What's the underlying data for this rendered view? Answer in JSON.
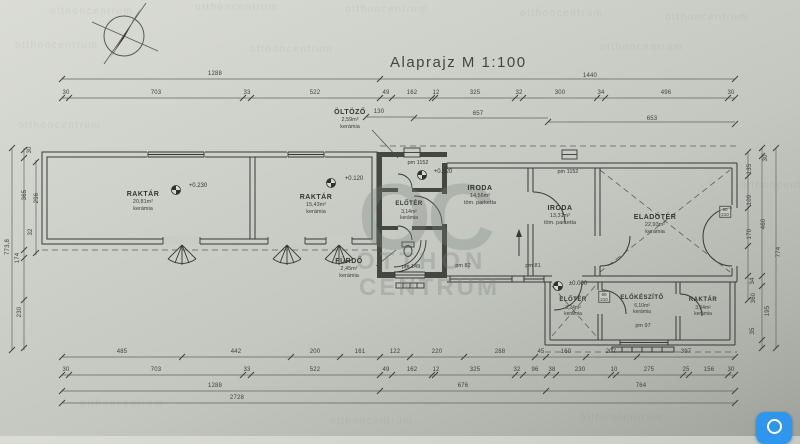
{
  "title": "Alaprajz M 1:100",
  "watermark": {
    "tile": "otthoncentrum",
    "monogram": "OC",
    "line1": "OTTHON",
    "line2": "CENTRUM"
  },
  "rooms": {
    "raktar1": {
      "name": "RAKTÁR",
      "area": "20,81m²",
      "floor": "kerámia"
    },
    "raktar2": {
      "name": "RAKTÁR",
      "area": "15,43m²",
      "floor": "kerámia"
    },
    "oltozo": {
      "name": "ÖLTÖZŐ",
      "area": "2,59m²",
      "floor": "kerámia"
    },
    "eloter1": {
      "name": "ELŐTÉR",
      "area": "3,14m²",
      "floor": "kerámia"
    },
    "furdo": {
      "name": "FÜRDŐ",
      "area": "2,45m²",
      "floor": "kerámia"
    },
    "iroda1": {
      "name": "IRODA",
      "area": "14,56m²",
      "floor": "töm. parketta"
    },
    "iroda2": {
      "name": "IRODA",
      "area": "13,31m²",
      "floor": "töm. parketta"
    },
    "eladoter": {
      "name": "ELADÓTÉR",
      "area": "22,93m²",
      "floor": "kerámia"
    },
    "eloter2": {
      "name": "ELŐTÉR",
      "area": "3,24m²",
      "floor": "kerámia"
    },
    "elokeszito": {
      "name": "ELŐKÉSZÍTŐ",
      "area": "6,10m²",
      "floor": "kerámia"
    },
    "raktar3": {
      "name": "RAKTÁR",
      "area": "3,04m²",
      "floor": "kerámia"
    }
  },
  "levels": {
    "l1": "+0.230",
    "l2": "+0.120",
    "l3": "+0.120",
    "l4": "±0.000"
  },
  "windows": {
    "w1": "pm 1152",
    "w2": "pm 1152",
    "w3": "pm 82",
    "w4": "pm 81",
    "w5": "pm 149",
    "w6": "pm 97"
  },
  "doors": {
    "door1": {
      "w": "90",
      "h": "210"
    },
    "door2": {
      "w": "90",
      "h": "210"
    }
  },
  "dims": {
    "top_overall": [
      "1288",
      "1440"
    ],
    "top_detail": [
      "30",
      "703",
      "33",
      "522",
      "49",
      "162",
      "12",
      "325",
      "32",
      "300",
      "34",
      "496",
      "30"
    ],
    "top_mid": [
      "130",
      "657",
      "653"
    ],
    "bottom_detail1": [
      "485",
      "442",
      "200",
      "161",
      "122",
      "220",
      "288",
      "45",
      "160",
      "207",
      "397"
    ],
    "bottom_detail2": [
      "30",
      "703",
      "33",
      "522",
      "49",
      "162",
      "12",
      "325",
      "32",
      "96",
      "38",
      "230",
      "10",
      "275",
      "25",
      "156",
      "30"
    ],
    "bottom_sub": [
      "1288",
      "676",
      "764"
    ],
    "bottom_total": [
      "2728"
    ],
    "left_col": [
      "30",
      "365",
      "296",
      "32",
      "174",
      "230",
      "773,8"
    ],
    "right_col": [
      "30",
      "135",
      "109",
      "170",
      "460",
      "34",
      "360",
      "195",
      "35",
      "774"
    ]
  },
  "widget": {
    "color": "#2e96ef"
  }
}
